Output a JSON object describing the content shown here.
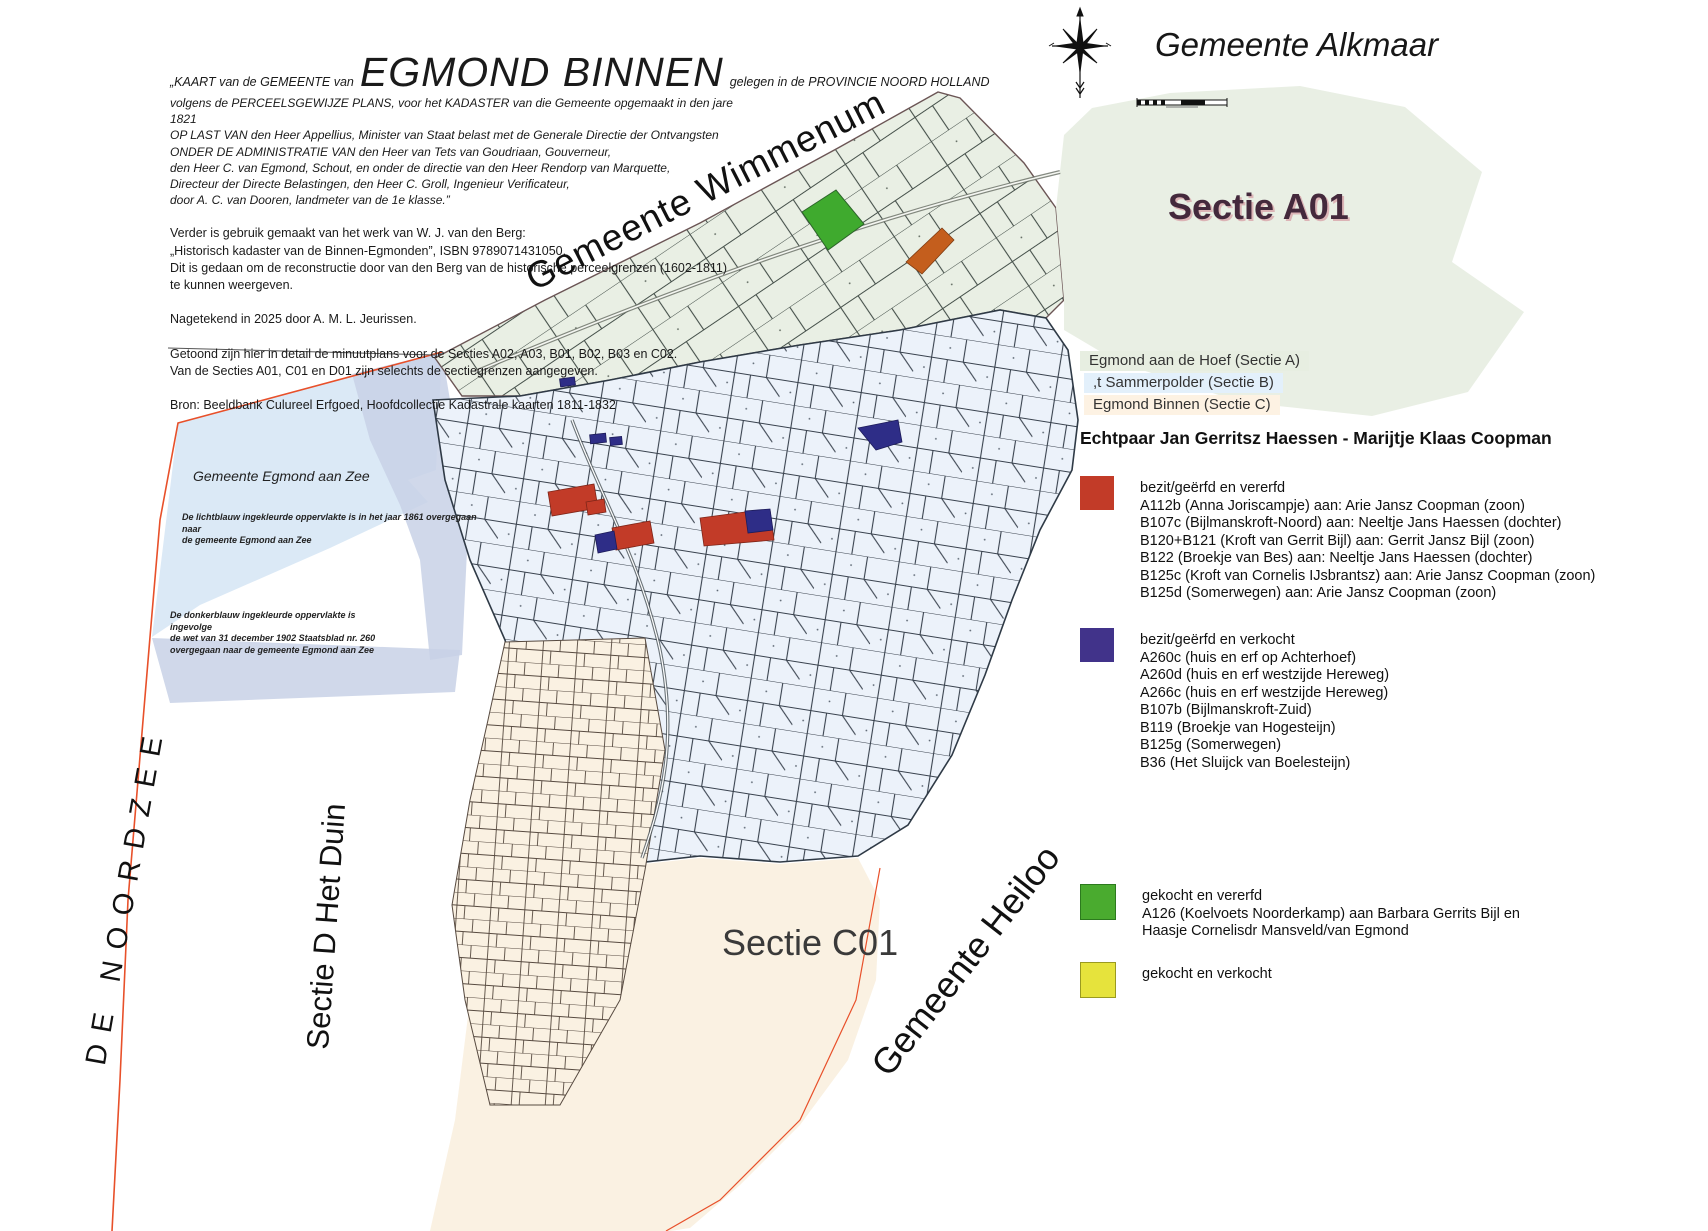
{
  "title_block": {
    "prefix": "„KAART van de GEMEENTE van",
    "main": "EGMOND BINNEN",
    "suffix": "gelegen in de PROVINCIE NOORD HOLLAND",
    "sub_lines": "volgens de PERCEELSGEWIJZE PLANS, voor het KADASTER van die Gemeente opgemaakt in den jare 1821\nOP LAST VAN den Heer Appellius, Minister van Staat belast met de Generale Directie der Ontvangsten\nONDER DE ADMINISTRATIE VAN den Heer van Tets van Goudriaan, Gouverneur,\nden Heer C. van Egmond, Schout, en onder de directie van den Heer Rendorp van Marquette,\nDirecteur der Directe Belastingen, den Heer C. Groll, Ingenieur Verificateur,\ndoor A. C. van Dooren, landmeter van de 1e klasse.”",
    "paragraph_1": "Verder is gebruik gemaakt van het werk van W. J. van den Berg:\n„Historisch kadaster van de Binnen-Egmonden”, ISBN 9789071431050.\nDit is gedaan om de reconstructie door van den Berg van de historische perceelgrenzen (1602-1811)\nte kunnen weergeven.",
    "paragraph_2": "Nagetekend in 2025 door A. M. L. Jeurissen.",
    "paragraph_3": "Getoond zijn hier in detail de minuutplans voor de Secties A02, A03, B01, B02, B03 en C02.\nVan de Secties A01,  C01 en D01 zijn selechts de sectiegrenzen aangegeven.",
    "paragraph_4": "Bron: Beeldbank Culureel Erfgoed, Hoofdcollectie Kadastrale kaarten 1811-1832"
  },
  "map_labels": {
    "alkmaar": "Gemeente Alkmaar",
    "wimmenum": "Gemeente Wimmenum",
    "sectie_a01": "Sectie A01",
    "sectie_c01": "Sectie C01",
    "heiloo": "Gemeente Heiloo",
    "het_duin": "Sectie D Het Duin",
    "noordzee": "DE NOORDZEE",
    "egmond_aan_zee": "Gemeente Egmond aan Zee"
  },
  "annotations": {
    "lichtblauw": "De lichtblauw ingekleurde oppervlakte is in het jaar 1861 overgegaan naar\nde gemeente Egmond aan Zee",
    "donkerblauw": "De donkerblauw ingekleurde oppervlakte is ingevolge\nde wet van 31 december 1902 Staatsblad nr. 260\novergegaan naar de gemeente Egmond aan Zee"
  },
  "section_chips": [
    {
      "label": "Egmond aan de Hoef (Sectie A)",
      "color": "#e7eee1"
    },
    {
      "label": ",t Sammerpolder (Sectie B)",
      "color": "#e3f0fb"
    },
    {
      "label": "Egmond Binnen (Sectie C)",
      "color": "#fdf2e3"
    }
  ],
  "legend": {
    "heading": "Echtpaar Jan Gerritsz Haessen - Marijtje Klaas Coopman",
    "groups": [
      {
        "color": "#c23b28",
        "title": "bezit/geërfd en vererfd",
        "items": [
          "A112b (Anna Joriscampje) aan: Arie Jansz Coopman (zoon)",
          "B107c (Bijlmanskroft-Noord) aan: Neeltje Jans Haessen (dochter)",
          "B120+B121 (Kroft van Gerrit Bijl) aan: Gerrit Jansz Bijl (zoon)",
          "B122 (Broekje van Bes) aan: Neeltje Jans Haessen (dochter)",
          "B125c (Kroft van Cornelis IJsbrantsz) aan: Arie Jansz Coopman (zoon)",
          "B125d (Somerwegen) aan: Arie Jansz Coopman (zoon)"
        ]
      },
      {
        "color": "#41338a",
        "title": "bezit/geërfd en verkocht",
        "items": [
          "A260c (huis en erf op Achterhoef)",
          "A260d (huis en erf westzijde Hereweg)",
          "A266c (huis en erf westzijde Hereweg)",
          "B107b (Bijlmanskroft-Zuid)",
          "B119 (Broekje van Hogesteijn)",
          "B125g (Somerwegen)",
          "B36 (Het Sluijck van Boelesteijn)"
        ]
      },
      {
        "color": "#4aab2f",
        "title": "gekocht en vererfd",
        "items": [
          "A126 (Koelvoets Noorderkamp) aan Barbara Gerrits Bijl en",
          "Haasje Cornelisdr Mansveld/van Egmond"
        ]
      },
      {
        "color": "#e6e33c",
        "title": "gekocht en verkocht",
        "items": []
      }
    ]
  },
  "colors": {
    "sectie_a_fill": "#e9efe4",
    "sectie_b_fill": "#ecf2fa",
    "sectie_c_fill": "#faf1e2",
    "sea_light": "#dbe9f6",
    "sea_dark": "#c8d1e6",
    "boundary_red": "#e8502a",
    "parcel_line": "#39424e",
    "sectie_a01_label": "#44293c",
    "legend_red": "#c23b28",
    "legend_blue": "#41338a",
    "legend_green": "#4aab2f",
    "legend_yellow": "#e6e33c"
  }
}
